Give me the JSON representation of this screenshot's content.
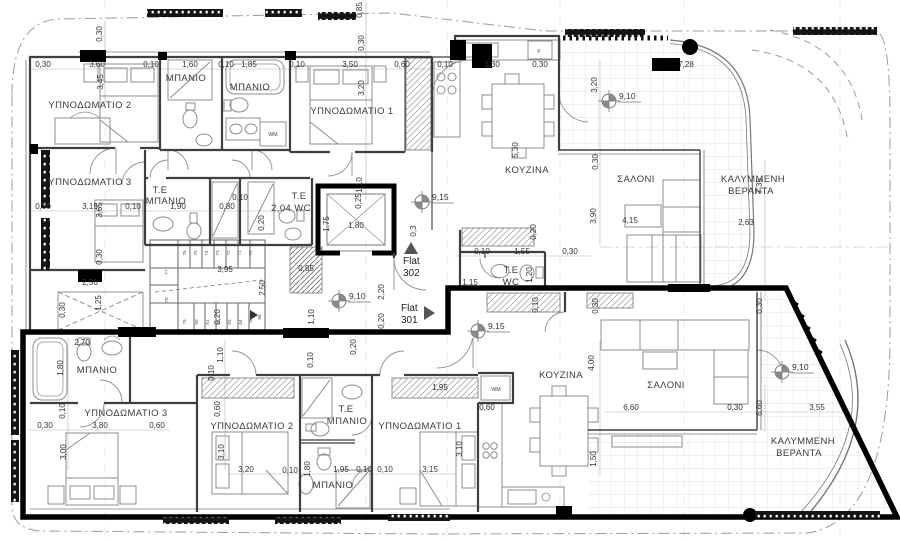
{
  "drawing": {
    "type": "architectural floor plan",
    "language": "Greek"
  },
  "rooms": [
    {
      "t": "ΥΠΝΟΔΩΜΑΤΙΟ 2",
      "x": 90,
      "y": 108
    },
    {
      "t": "ΜΠΑΝΙΟ",
      "x": 186,
      "y": 81
    },
    {
      "t": "ΜΠΑΝΙΟ",
      "x": 250,
      "y": 90
    },
    {
      "t": "ΥΠΝΟΔΩΜΑΤΙΟ 1",
      "x": 352,
      "y": 114
    },
    {
      "t": "ΚΟΥΖΙΝΑ",
      "x": 527,
      "y": 173
    },
    {
      "t": "ΣΑΛΟΝΙ",
      "x": 636,
      "y": 182
    },
    {
      "t": "ΚΑΛΥΜΜΕΝΗ",
      "x": 753,
      "y": 182
    },
    {
      "t": "ΒΕΡΑΝΤΑ",
      "x": 751,
      "y": 194
    },
    {
      "t": "ΥΠΝΟΔΩΜΑΤΙΟ 3",
      "x": 90,
      "y": 185
    },
    {
      "t": "Τ.Ε",
      "x": 160,
      "y": 193
    },
    {
      "t": "ΜΠΑΝΙΟ",
      "x": 166,
      "y": 204
    },
    {
      "t": "Τ.Ε",
      "x": 299,
      "y": 199
    },
    {
      "t": "2,04 WC",
      "x": 291,
      "y": 211
    },
    {
      "t": "Τ.Ε",
      "x": 511,
      "y": 273
    },
    {
      "t": "WC",
      "x": 511,
      "y": 285
    },
    {
      "t": "ΜΠΑΝΙΟ",
      "x": 97,
      "y": 373
    },
    {
      "t": "ΥΠΝΟΔΩΜΑΤΙΟ 3",
      "x": 126,
      "y": 416
    },
    {
      "t": "ΥΠΝΟΔΩΜΑΤΙΟ 2",
      "x": 252,
      "y": 429
    },
    {
      "t": "Τ.Ε",
      "x": 346,
      "y": 412
    },
    {
      "t": "ΜΠΑΝΙΟ",
      "x": 347,
      "y": 424
    },
    {
      "t": "ΥΠΝΟΔΩΜΑΤΙΟ 1",
      "x": 420,
      "y": 429
    },
    {
      "t": "ΜΠΑΝΙΟ",
      "x": 333,
      "y": 488
    },
    {
      "t": "ΚΟΥΖΙΝΑ",
      "x": 561,
      "y": 378
    },
    {
      "t": "ΣΑΛΟΝΙ",
      "x": 666,
      "y": 388
    },
    {
      "t": "ΚΑΛΥΜΜΕΝΗ",
      "x": 803,
      "y": 444
    },
    {
      "t": "ΒΕΡΑΝΤΑ",
      "x": 799,
      "y": 456
    }
  ],
  "dims_h": [
    {
      "t": "0,30",
      "x": 43,
      "y": 67
    },
    {
      "t": "3,60",
      "x": 97,
      "y": 67
    },
    {
      "t": "0,10",
      "x": 151,
      "y": 67
    },
    {
      "t": "1,60",
      "x": 190,
      "y": 67
    },
    {
      "t": "0,10",
      "x": 226,
      "y": 67
    },
    {
      "t": "1,85",
      "x": 249,
      "y": 67
    },
    {
      "t": "0,10",
      "x": 297,
      "y": 67
    },
    {
      "t": "3,50",
      "x": 350,
      "y": 67
    },
    {
      "t": "0,60",
      "x": 402,
      "y": 67
    },
    {
      "t": "0,10",
      "x": 445,
      "y": 67
    },
    {
      "t": "3,30",
      "x": 492,
      "y": 67
    },
    {
      "t": "0,30",
      "x": 540,
      "y": 67
    },
    {
      "t": "7,28",
      "x": 686,
      "y": 67
    },
    {
      "t": "0,30",
      "x": 43,
      "y": 209
    },
    {
      "t": "3,15",
      "x": 90,
      "y": 209
    },
    {
      "t": "0,10",
      "x": 133,
      "y": 209
    },
    {
      "t": "1,90",
      "x": 178,
      "y": 209
    },
    {
      "t": "0,80",
      "x": 227,
      "y": 209
    },
    {
      "t": "0,10",
      "x": 240,
      "y": 200
    },
    {
      "t": "1,80",
      "x": 356,
      "y": 228
    },
    {
      "t": "3,95",
      "x": 225,
      "y": 272
    },
    {
      "t": "2,50",
      "x": 90,
      "y": 285
    },
    {
      "t": "0,85",
      "x": 306,
      "y": 271
    },
    {
      "t": "0,10",
      "x": 482,
      "y": 254
    },
    {
      "t": "1,55",
      "x": 522,
      "y": 254
    },
    {
      "t": "0,30",
      "x": 570,
      "y": 254
    },
    {
      "t": "1,15",
      "x": 470,
      "y": 285
    },
    {
      "t": "4,15",
      "x": 630,
      "y": 223
    },
    {
      "t": "2,63",
      "x": 746,
      "y": 225
    },
    {
      "t": "2,70",
      "x": 82,
      "y": 345
    },
    {
      "t": "0,30",
      "x": 45,
      "y": 428
    },
    {
      "t": "3,80",
      "x": 100,
      "y": 428
    },
    {
      "t": "0,60",
      "x": 157,
      "y": 428
    },
    {
      "t": "3,20",
      "x": 246,
      "y": 472
    },
    {
      "t": "0,10",
      "x": 290,
      "y": 473
    },
    {
      "t": "1,95",
      "x": 341,
      "y": 472
    },
    {
      "t": "0,10",
      "x": 364,
      "y": 472
    },
    {
      "t": "0,10",
      "x": 385,
      "y": 472
    },
    {
      "t": "3,15",
      "x": 430,
      "y": 472
    },
    {
      "t": "1,95",
      "x": 440,
      "y": 390
    },
    {
      "t": "0,60",
      "x": 487,
      "y": 410
    },
    {
      "t": "6,60",
      "x": 631,
      "y": 410
    },
    {
      "t": "0,30",
      "x": 735,
      "y": 410
    },
    {
      "t": "3,55",
      "x": 817,
      "y": 410
    }
  ],
  "dims_v": [
    {
      "t": "0,30",
      "x": 102,
      "y": 34
    },
    {
      "t": "3,45",
      "x": 103,
      "y": 82
    },
    {
      "t": "0,85",
      "x": 362,
      "y": 10
    },
    {
      "t": "0,30",
      "x": 364,
      "y": 43
    },
    {
      "t": "3,20",
      "x": 364,
      "y": 88
    },
    {
      "t": "1,10",
      "x": 362,
      "y": 185
    },
    {
      "t": "5,30",
      "x": 518,
      "y": 150
    },
    {
      "t": "3,20",
      "x": 597,
      "y": 85
    },
    {
      "t": "7,35",
      "x": 762,
      "y": 186
    },
    {
      "t": "3,65",
      "x": 102,
      "y": 210
    },
    {
      "t": "0,30",
      "x": 102,
      "y": 257
    },
    {
      "t": "0,20",
      "x": 264,
      "y": 223
    },
    {
      "t": "0,25",
      "x": 361,
      "y": 201
    },
    {
      "t": "1,75",
      "x": 329,
      "y": 224
    },
    {
      "t": "2,50",
      "x": 265,
      "y": 288
    },
    {
      "t": "1,25",
      "x": 101,
      "y": 303
    },
    {
      "t": "0,30",
      "x": 65,
      "y": 310
    },
    {
      "t": "0,20",
      "x": 220,
      "y": 317
    },
    {
      "t": "1,10",
      "x": 314,
      "y": 317
    },
    {
      "t": "2,20",
      "x": 384,
      "y": 292
    },
    {
      "t": "0,20",
      "x": 384,
      "y": 321
    },
    {
      "t": "0,3",
      "x": 416,
      "y": 231
    },
    {
      "t": "0,20",
      "x": 536,
      "y": 232
    },
    {
      "t": "1,20",
      "x": 532,
      "y": 275
    },
    {
      "t": "0,10",
      "x": 538,
      "y": 305
    },
    {
      "t": "0,30",
      "x": 598,
      "y": 306
    },
    {
      "t": "0,30",
      "x": 762,
      "y": 306
    },
    {
      "t": "3,90",
      "x": 596,
      "y": 216
    },
    {
      "t": "0,30",
      "x": 598,
      "y": 162
    },
    {
      "t": "1,80",
      "x": 63,
      "y": 368
    },
    {
      "t": "0,10",
      "x": 65,
      "y": 411
    },
    {
      "t": "3,00",
      "x": 66,
      "y": 452
    },
    {
      "t": "1,10",
      "x": 223,
      "y": 355
    },
    {
      "t": "0,10",
      "x": 214,
      "y": 373
    },
    {
      "t": "0,60",
      "x": 220,
      "y": 409
    },
    {
      "t": "3,10",
      "x": 224,
      "y": 452
    },
    {
      "t": "1,80",
      "x": 310,
      "y": 469
    },
    {
      "t": "0,10",
      "x": 313,
      "y": 360
    },
    {
      "t": "0,20",
      "x": 356,
      "y": 347
    },
    {
      "t": "3,10",
      "x": 462,
      "y": 449
    },
    {
      "t": "4,00",
      "x": 594,
      "y": 363
    },
    {
      "t": "1,50",
      "x": 596,
      "y": 459
    },
    {
      "t": "6,60",
      "x": 762,
      "y": 408
    }
  ],
  "levels": [
    {
      "t": "9,15",
      "x": 422,
      "y": 202
    },
    {
      "t": "9,15",
      "x": 478,
      "y": 331
    },
    {
      "t": "9,10",
      "x": 339,
      "y": 301
    },
    {
      "t": "9,10",
      "x": 609,
      "y": 101
    },
    {
      "t": "9,10",
      "x": 782,
      "y": 372
    }
  ],
  "flats": [
    {
      "line1": "Flat",
      "line2": "302",
      "x": 403,
      "y": 264,
      "dir": "up",
      "tri": "404,254 418,254 411,242"
    },
    {
      "line1": "Flat",
      "line2": "301",
      "x": 401,
      "y": 311,
      "dir": "right",
      "tri": "424,306 424,320 435,313"
    }
  ],
  "stair_numbers": [
    {
      "t": "76",
      "x": 186,
      "y": 253
    },
    {
      "t": "75",
      "x": 197,
      "y": 253
    },
    {
      "t": "74",
      "x": 208,
      "y": 253
    },
    {
      "t": "73",
      "x": 219,
      "y": 253
    },
    {
      "t": "72",
      "x": 230,
      "y": 253
    },
    {
      "t": "71",
      "x": 241,
      "y": 253
    },
    {
      "t": "70",
      "x": 252,
      "y": 253
    },
    {
      "t": "77",
      "x": 168,
      "y": 272
    },
    {
      "t": "78",
      "x": 168,
      "y": 300
    },
    {
      "t": "79",
      "x": 186,
      "y": 322
    },
    {
      "t": "80",
      "x": 198,
      "y": 322
    },
    {
      "t": "81",
      "x": 209,
      "y": 322
    },
    {
      "t": "82",
      "x": 220,
      "y": 322
    },
    {
      "t": "83",
      "x": 231,
      "y": 322
    },
    {
      "t": "84",
      "x": 242,
      "y": 322
    },
    {
      "t": "85",
      "x": 252,
      "y": 320
    },
    {
      "t": "86",
      "x": 261,
      "y": 317
    }
  ],
  "misc": [
    {
      "t": "WM",
      "x": 273,
      "y": 136
    },
    {
      "t": "WM",
      "x": 496,
      "y": 391
    },
    {
      "t": "F",
      "x": 539,
      "y": 53
    }
  ]
}
